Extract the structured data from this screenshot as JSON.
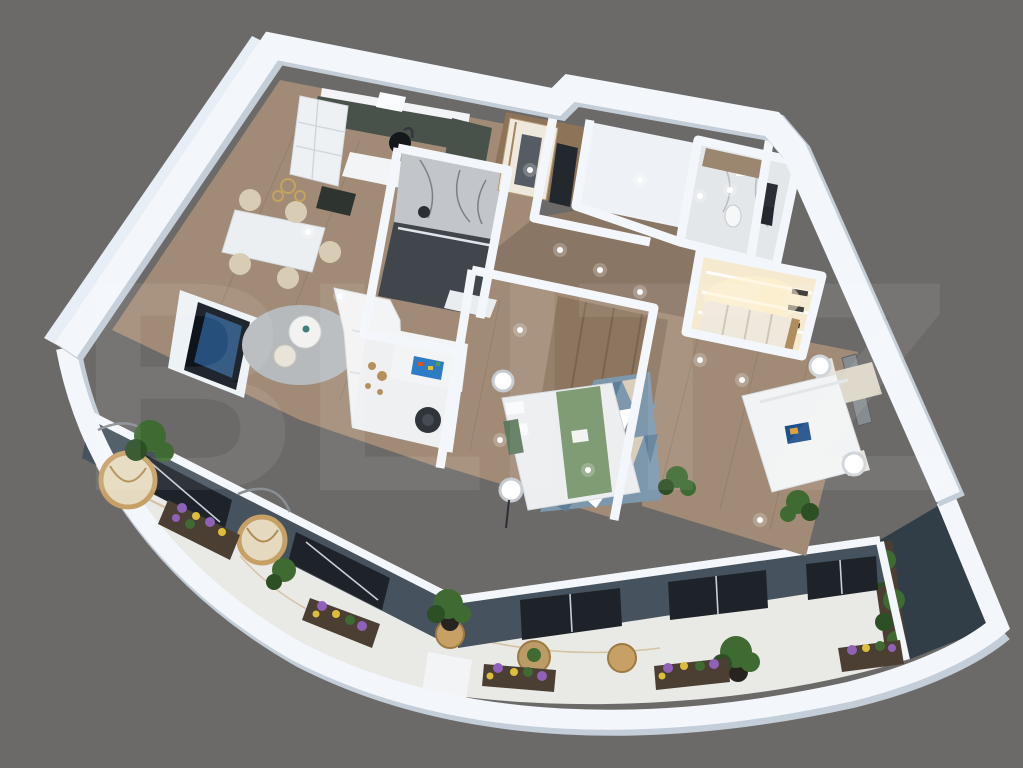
{
  "scene": {
    "type": "3d-apartment-floor-plan-render",
    "watermark_text": "BLITZ"
  },
  "palette": {
    "background": "#6b6a68",
    "wall_white": "#f3f7fb",
    "wall_face": "#e7eef6",
    "wall_shadow": "#c3ced9",
    "floor_wood": "#a18b76",
    "floor_wood_dark": "#8a7664",
    "floor_entry": "#8d7357",
    "floor_bright": "#eef2f6",
    "bath_light": "#e3e7ea",
    "marble_gray": "#c2c6cb",
    "dark_floor": "#41464d",
    "terrace_marble": "#e9e9e6",
    "marble_vein": "#bf9455",
    "slate_wall": "#46535e",
    "slate_dark": "#313d47",
    "window_glass": "#1d2329",
    "kitchen_green": "#49524a",
    "counter_white": "#f2f4f5",
    "sofa_white": "#f3f4f5",
    "rug_gray": "#b7babc",
    "chair_beige": "#d8cdb4",
    "wood_wall": "#8c7660",
    "bed_green": "#7f9c74",
    "tri_steel": "#5e7f99",
    "tri_mid": "#7d97ad",
    "tri_tan": "#d9cdbb",
    "tri_light": "#ffffff",
    "tv_dark": "#0e141c",
    "tv_blue": "#2d5f93",
    "rattan": "#c7a066",
    "rattan_dark": "#9c7a42",
    "cushion": "#e5dabf",
    "plant_green": "#3f6b33",
    "plant_dark": "#2c4f24",
    "flower_purple": "#9061b8",
    "flower_yellow": "#ddbe3a",
    "planter_wood": "#4b3f33",
    "gold_decor": "#b4905a",
    "fixture_dark": "#23282e",
    "closet_cream": "#efe9dd",
    "wardrobe_glow": "#f5ead0"
  }
}
